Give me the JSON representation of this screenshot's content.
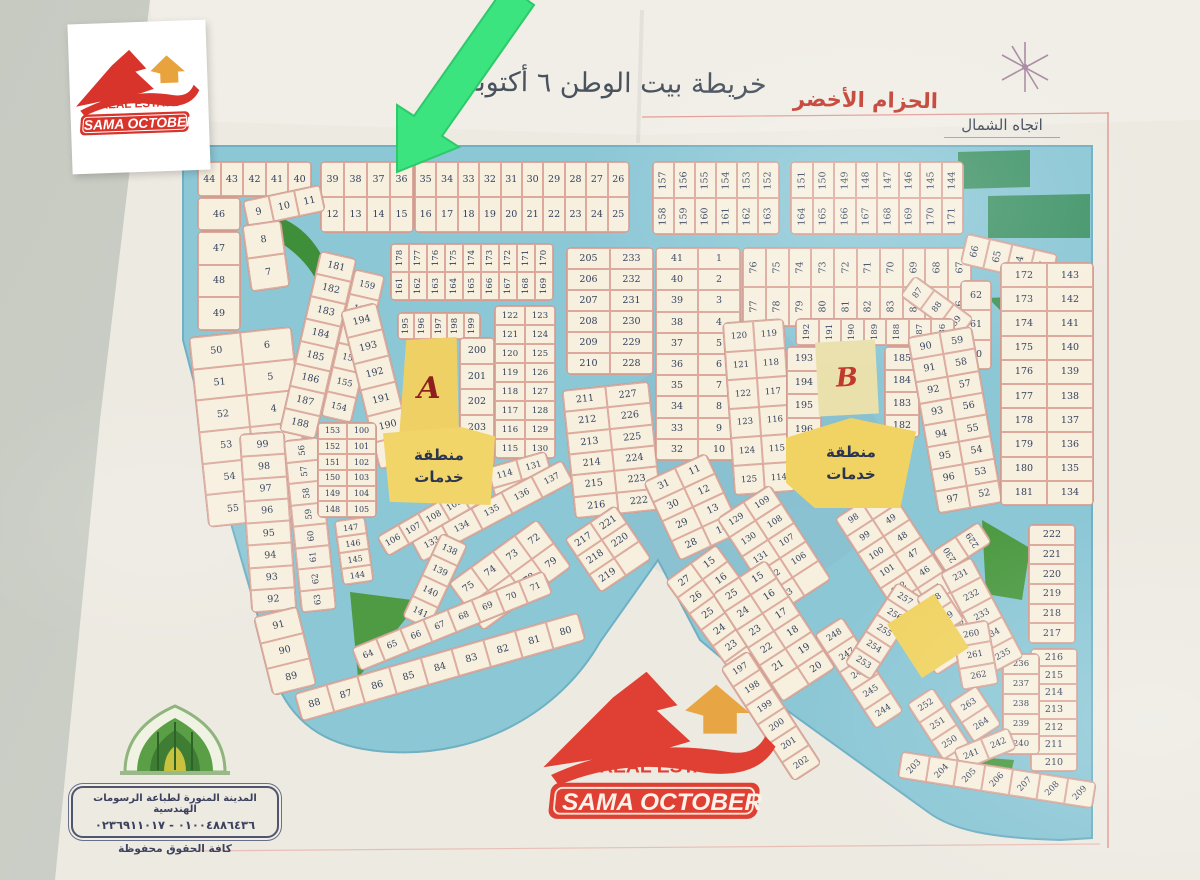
{
  "header": {
    "title": "خريطة بيت الوطن ٦ أكتوبر",
    "green_belt_label": "الحزام الأخضر",
    "north_label": "اتجاه الشمال"
  },
  "logo": {
    "brand": "SAMA OCTOBER",
    "tagline": "REAL ESTATE"
  },
  "stamp": {
    "line1": "المدينة المنورة لطباعة الرسومات الهندسية",
    "line2": "٠١٠٠٤٨٨٦٤٣٦ - ٠٢٣٦٩١١٠١٧",
    "line3": "كافة الحقوق محفوظة"
  },
  "map": {
    "zone_a_label": "A",
    "zone_b_label": "B",
    "service_area_line1": "منطقة",
    "service_area_line2": "خدمات",
    "colors": {
      "road": "#8CC7D6",
      "plot": "#f7f0df",
      "plot_border": "#cf9d92",
      "service_yellow": "#F0D362",
      "park_green": "#4E9B44",
      "arrow_green": "#3BE47E",
      "frame_pink": "#e39a94",
      "paper": "#EDEAE2"
    },
    "blocks": [
      {
        "x": 197,
        "y": 161,
        "w": 113,
        "h": 34,
        "c": 5,
        "nums": [
          44,
          43,
          42,
          41,
          40
        ]
      },
      {
        "x": 320,
        "y": 161,
        "w": 92,
        "h": 70,
        "c": 4,
        "nums": [
          39,
          38,
          37,
          36,
          12,
          13,
          14,
          15
        ]
      },
      {
        "x": 414,
        "y": 161,
        "w": 214,
        "h": 70,
        "c": 10,
        "nums": [
          35,
          34,
          33,
          32,
          31,
          30,
          29,
          28,
          27,
          26,
          16,
          17,
          18,
          19,
          20,
          21,
          22,
          23,
          24,
          25
        ]
      },
      {
        "x": 197,
        "y": 197,
        "w": 42,
        "h": 32,
        "c": 1,
        "nums": [
          46
        ]
      },
      {
        "x": 244,
        "y": 192,
        "w": 78,
        "h": 26,
        "c": 3,
        "rot": -12,
        "nums": [
          9,
          10,
          11
        ]
      },
      {
        "x": 197,
        "y": 231,
        "w": 42,
        "h": 98,
        "c": 1,
        "nums": [
          47,
          48,
          49
        ]
      },
      {
        "x": 246,
        "y": 222,
        "w": 38,
        "h": 66,
        "c": 1,
        "rot": -8,
        "nums": [
          8,
          7
        ]
      },
      {
        "x": 198,
        "y": 331,
        "w": 102,
        "h": 190,
        "c": 2,
        "rot": -6,
        "nums": [
          50,
          6,
          51,
          5,
          52,
          4,
          53,
          3,
          54,
          2,
          55,
          1
        ]
      },
      {
        "x": 652,
        "y": 161,
        "w": 126,
        "h": 72,
        "c": 6,
        "vert": true,
        "nums": [
          157,
          156,
          155,
          154,
          153,
          152,
          158,
          159,
          160,
          161,
          162,
          163
        ]
      },
      {
        "x": 790,
        "y": 161,
        "w": 172,
        "h": 72,
        "c": 8,
        "vert": true,
        "nums": [
          151,
          150,
          149,
          148,
          147,
          146,
          145,
          144,
          164,
          165,
          166,
          167,
          168,
          169,
          170,
          171
        ]
      },
      {
        "x": 390,
        "y": 243,
        "w": 162,
        "h": 56,
        "c": 9,
        "vert": true,
        "fs": 8.5,
        "nums": [
          178,
          177,
          176,
          175,
          174,
          173,
          172,
          171,
          170,
          161,
          162,
          163,
          164,
          165,
          166,
          167,
          168,
          169
        ]
      },
      {
        "x": 299,
        "y": 252,
        "w": 36,
        "h": 184,
        "c": 1,
        "rot": 13,
        "nums": [
          181,
          182,
          183,
          184,
          185,
          186,
          187,
          188
        ]
      },
      {
        "x": 337,
        "y": 270,
        "w": 30,
        "h": 150,
        "c": 1,
        "rot": 13,
        "fs": 8.5,
        "nums": [
          159,
          158,
          157,
          156,
          155,
          154
        ]
      },
      {
        "x": 359,
        "y": 304,
        "w": 36,
        "h": 162,
        "c": 1,
        "rot": -14,
        "nums": [
          194,
          193,
          192,
          191,
          190,
          189
        ]
      },
      {
        "x": 397,
        "y": 312,
        "w": 82,
        "h": 26,
        "c": 5,
        "vert": true,
        "fs": 8.5,
        "nums": [
          195,
          196,
          197,
          198,
          199
        ]
      },
      {
        "x": 459,
        "y": 337,
        "w": 34,
        "h": 128,
        "c": 1,
        "nums": [
          200,
          201,
          202,
          203,
          204
        ]
      },
      {
        "x": 494,
        "y": 305,
        "w": 60,
        "h": 152,
        "c": 2,
        "fs": 8.5,
        "nums": [
          122,
          123,
          121,
          124,
          120,
          125,
          119,
          126,
          118,
          127,
          117,
          128,
          116,
          129,
          115,
          130
        ]
      },
      {
        "x": 491,
        "y": 458,
        "w": 60,
        "h": 42,
        "c": 2,
        "rot": -16,
        "fs": 8.5,
        "nums": [
          114,
          131,
          113,
          132
        ]
      },
      {
        "x": 406,
        "y": 498,
        "w": 170,
        "h": 24,
        "c": 5,
        "rot": -28,
        "fs": 8.5,
        "nums": [
          133,
          134,
          135,
          136,
          137
        ]
      },
      {
        "x": 420,
        "y": 534,
        "w": 28,
        "h": 92,
        "c": 1,
        "rot": 25,
        "fs": 8.5,
        "nums": [
          138,
          139,
          140,
          141
        ]
      },
      {
        "x": 245,
        "y": 432,
        "w": 44,
        "h": 178,
        "c": 1,
        "rot": -4,
        "nums": [
          99,
          98,
          97,
          96,
          95,
          94,
          93,
          92
        ]
      },
      {
        "x": 262,
        "y": 610,
        "w": 44,
        "h": 80,
        "c": 1,
        "rot": -14,
        "nums": [
          91,
          90,
          89
        ]
      },
      {
        "x": 292,
        "y": 438,
        "w": 34,
        "h": 172,
        "c": 1,
        "vert": true,
        "rot": -6,
        "fs": 8.5,
        "nums": [
          56,
          57,
          58,
          59,
          60,
          61,
          62,
          63
        ]
      },
      {
        "x": 317,
        "y": 422,
        "w": 58,
        "h": 94,
        "c": 2,
        "fs": 8,
        "nums": [
          153,
          100,
          152,
          101,
          151,
          102,
          150,
          103,
          149,
          104,
          148,
          105
        ]
      },
      {
        "x": 338,
        "y": 518,
        "w": 30,
        "h": 64,
        "c": 1,
        "rot": -8,
        "fs": 8,
        "nums": [
          147,
          146,
          145,
          144
        ]
      },
      {
        "x": 374,
        "y": 505,
        "w": 118,
        "h": 22,
        "c": 5,
        "rot": -30,
        "fs": 8.5,
        "nums": [
          106,
          107,
          108,
          109,
          110
        ]
      },
      {
        "x": 455,
        "y": 545,
        "w": 108,
        "h": 58,
        "c": 4,
        "rot": -36,
        "nums": [
          75,
          74,
          73,
          72,
          76,
          77,
          78,
          79
        ]
      },
      {
        "x": 348,
        "y": 608,
        "w": 206,
        "h": 24,
        "c": 8,
        "rot": -22,
        "fs": 8.5,
        "nums": [
          64,
          65,
          66,
          67,
          68,
          69,
          70,
          71
        ]
      },
      {
        "x": 292,
        "y": 652,
        "w": 294,
        "h": 28,
        "c": 9,
        "rot": -16,
        "nums": [
          88,
          87,
          86,
          85,
          84,
          83,
          82,
          81,
          80
        ]
      },
      {
        "x": 566,
        "y": 247,
        "w": 86,
        "h": 126,
        "c": 2,
        "nums": [
          205,
          233,
          206,
          232,
          207,
          231,
          208,
          230,
          209,
          229,
          210,
          228
        ]
      },
      {
        "x": 568,
        "y": 385,
        "w": 86,
        "h": 128,
        "c": 2,
        "rot": -6,
        "nums": [
          211,
          227,
          212,
          226,
          213,
          225,
          214,
          224,
          215,
          223,
          216,
          222
        ]
      },
      {
        "x": 577,
        "y": 516,
        "w": 60,
        "h": 64,
        "c": 2,
        "rot": -34,
        "nums": [
          217,
          221,
          218,
          220,
          219,
          ""
        ]
      },
      {
        "x": 655,
        "y": 247,
        "w": 84,
        "h": 212,
        "c": 2,
        "nums": [
          41,
          1,
          40,
          2,
          39,
          3,
          38,
          4,
          37,
          5,
          36,
          6,
          35,
          7,
          34,
          8,
          33,
          9,
          32,
          10
        ]
      },
      {
        "x": 658,
        "y": 463,
        "w": 68,
        "h": 86,
        "c": 2,
        "rot": -25,
        "nums": [
          31,
          11,
          30,
          12,
          29,
          13,
          28,
          14
        ]
      },
      {
        "x": 700,
        "y": 549,
        "w": 62,
        "h": 140,
        "c": 2,
        "rot": -36,
        "nums": [
          27,
          15,
          26,
          16,
          25,
          17,
          24,
          18,
          23,
          19,
          22,
          20,
          21,
          ""
        ]
      },
      {
        "x": 742,
        "y": 247,
        "w": 228,
        "h": 78,
        "c": 10,
        "vert": true,
        "nums": [
          76,
          75,
          74,
          73,
          72,
          71,
          70,
          69,
          68,
          67,
          77,
          78,
          79,
          80,
          81,
          82,
          83,
          84,
          85,
          86
        ]
      },
      {
        "x": 962,
        "y": 243,
        "w": 92,
        "h": 30,
        "c": 4,
        "rot": 13,
        "vert": true,
        "nums": [
          66,
          65,
          64,
          63
        ]
      },
      {
        "x": 960,
        "y": 280,
        "w": 30,
        "h": 88,
        "c": 1,
        "nums": [
          62,
          61,
          60
        ]
      },
      {
        "x": 900,
        "y": 294,
        "w": 72,
        "h": 24,
        "c": 3,
        "rot": 36,
        "vert": true,
        "fs": 8.5,
        "nums": [
          87,
          88,
          89
        ]
      },
      {
        "x": 728,
        "y": 320,
        "w": 60,
        "h": 172,
        "c": 2,
        "rot": -4,
        "fs": 8.5,
        "nums": [
          120,
          119,
          121,
          118,
          122,
          117,
          123,
          116,
          124,
          115,
          125,
          114
        ]
      },
      {
        "x": 795,
        "y": 318,
        "w": 158,
        "h": 26,
        "c": 7,
        "vert": true,
        "fs": 8.5,
        "nums": [
          192,
          191,
          190,
          189,
          188,
          187,
          186
        ]
      },
      {
        "x": 786,
        "y": 346,
        "w": 34,
        "h": 94,
        "c": 1,
        "nums": [
          193,
          194,
          195,
          196
        ]
      },
      {
        "x": 884,
        "y": 346,
        "w": 34,
        "h": 90,
        "c": 1,
        "nums": [
          185,
          184,
          183,
          182
        ]
      },
      {
        "x": 922,
        "y": 330,
        "w": 64,
        "h": 178,
        "c": 2,
        "rot": -10,
        "nums": [
          90,
          59,
          91,
          58,
          92,
          57,
          93,
          56,
          94,
          55,
          95,
          54,
          96,
          53,
          97,
          52
        ]
      },
      {
        "x": 1000,
        "y": 262,
        "w": 92,
        "h": 242,
        "c": 2,
        "nums": [
          172,
          143,
          173,
          142,
          174,
          141,
          175,
          140,
          176,
          139,
          177,
          138,
          178,
          137,
          179,
          136,
          180,
          135,
          181,
          134
        ]
      },
      {
        "x": 742,
        "y": 492,
        "w": 62,
        "h": 112,
        "c": 2,
        "rot": -33,
        "fs": 8.5,
        "nums": [
          129,
          109,
          130,
          108,
          131,
          107,
          132,
          106,
          133,
          ""
        ]
      },
      {
        "x": 742,
        "y": 566,
        "w": 62,
        "h": 128,
        "c": 2,
        "rot": -33,
        "nums": [
          25,
          15,
          24,
          16,
          23,
          17,
          22,
          18,
          21,
          19,
          "",
          20
        ]
      },
      {
        "x": 880,
        "y": 486,
        "w": 62,
        "h": 186,
        "c": 2,
        "rot": -33,
        "fs": 8.5,
        "nums": [
          98,
          50,
          99,
          49,
          100,
          48,
          101,
          47,
          102,
          46,
          103,
          45,
          104,
          44,
          105,
          43,
          "",
          42
        ]
      },
      {
        "x": 754,
        "y": 648,
        "w": 32,
        "h": 134,
        "c": 1,
        "rot": -33,
        "fs": 8.5,
        "nums": [
          197,
          198,
          199,
          200,
          201,
          202
        ]
      },
      {
        "x": 842,
        "y": 616,
        "w": 32,
        "h": 112,
        "c": 1,
        "rot": -33,
        "fs": 8.5,
        "nums": [
          248,
          247,
          246,
          245,
          244
        ]
      },
      {
        "x": 868,
        "y": 582,
        "w": 30,
        "h": 96,
        "c": 1,
        "rot": 33,
        "fs": 8.5,
        "nums": [
          257,
          256,
          255,
          254,
          253
        ]
      },
      {
        "x": 925,
        "y": 586,
        "w": 28,
        "h": 44,
        "c": 1,
        "rot": -33,
        "fs": 8.5,
        "nums": [
          258,
          259
        ]
      },
      {
        "x": 934,
        "y": 534,
        "w": 54,
        "h": 24,
        "c": 2,
        "rot": -33,
        "vert": true,
        "fs": 8.5,
        "nums": [
          230,
          229
        ]
      },
      {
        "x": 1028,
        "y": 524,
        "w": 46,
        "h": 118,
        "c": 1,
        "nums": [
          222,
          221,
          220,
          219,
          218,
          217
        ]
      },
      {
        "x": 1030,
        "y": 648,
        "w": 46,
        "h": 122,
        "c": 1,
        "nums": [
          216,
          215,
          214,
          213,
          212,
          211,
          210
        ]
      },
      {
        "x": 1002,
        "y": 653,
        "w": 36,
        "h": 100,
        "c": 1,
        "fs": 8.5,
        "nums": [
          236,
          237,
          238,
          239,
          240
        ]
      },
      {
        "x": 964,
        "y": 558,
        "w": 34,
        "h": 112,
        "c": 1,
        "rot": -28,
        "fs": 8.5,
        "nums": [
          231,
          232,
          233,
          234,
          235
        ]
      },
      {
        "x": 956,
        "y": 622,
        "w": 36,
        "h": 64,
        "c": 1,
        "rot": -10,
        "fs": 8.5,
        "nums": [
          260,
          261,
          262
        ]
      },
      {
        "x": 958,
        "y": 690,
        "w": 32,
        "h": 46,
        "c": 1,
        "rot": -33,
        "fs": 8.5,
        "nums": [
          263,
          264
        ]
      },
      {
        "x": 928,
        "y": 688,
        "w": 30,
        "h": 88,
        "c": 1,
        "rot": -33,
        "fs": 8.5,
        "nums": [
          252,
          251,
          250,
          249
        ]
      },
      {
        "x": 955,
        "y": 737,
        "w": 58,
        "h": 22,
        "c": 2,
        "rot": -22,
        "fs": 8.5,
        "nums": [
          241,
          242
        ]
      },
      {
        "x": 898,
        "y": 766,
        "w": 196,
        "h": 26,
        "c": 7,
        "rot": 9,
        "tilt": -55,
        "fs": 8.5,
        "nums": [
          203,
          204,
          205,
          206,
          207,
          208,
          209
        ]
      }
    ]
  }
}
